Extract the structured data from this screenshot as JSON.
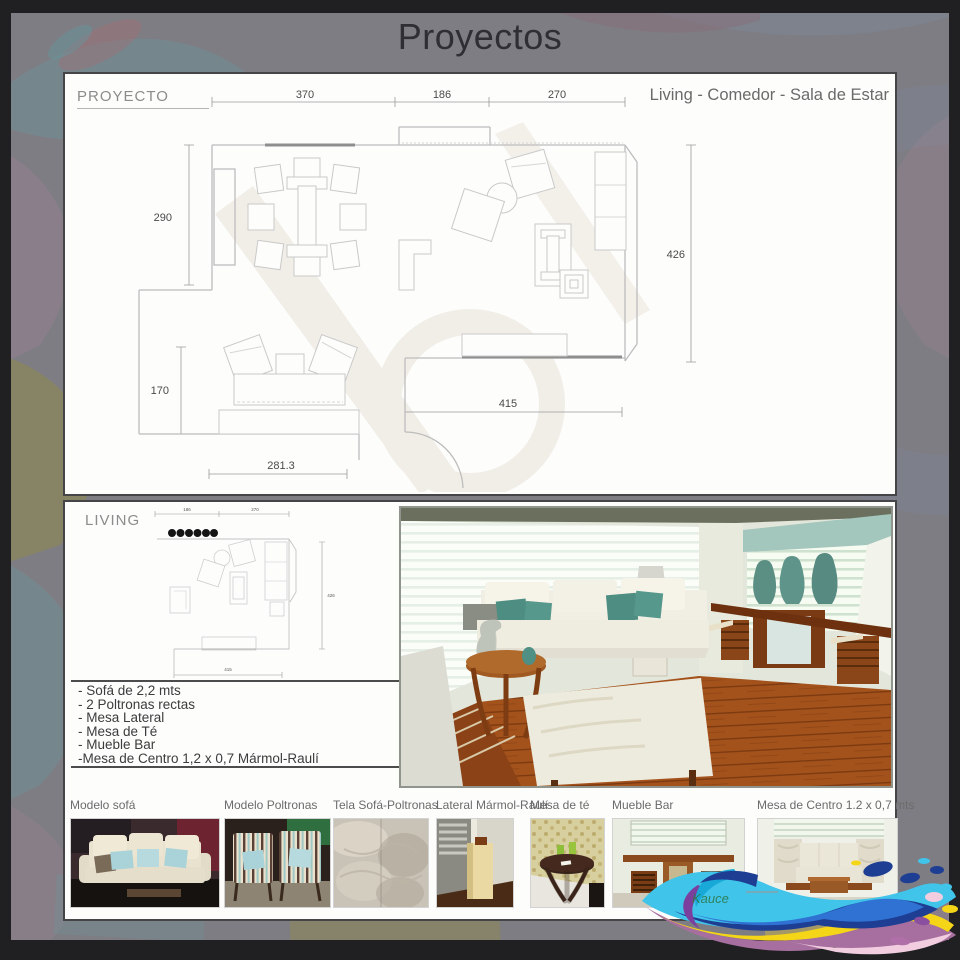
{
  "title": "Proyectos",
  "panel_proyecto": {
    "label": "PROYECTO",
    "subtitle": "Living - Comedor - Sala de Estar",
    "dimensions": {
      "top": [
        "370",
        "186",
        "270"
      ],
      "left_upper": "290",
      "left_lower": "170",
      "right": "426",
      "bottom_right": "415",
      "bottom_left": "281.3"
    }
  },
  "panel_living": {
    "label": "LIVING",
    "plan_dims": {
      "top_left": "186",
      "top_right": "270",
      "right": "426",
      "bottom": "415"
    },
    "furniture_list": [
      "- Sofá de 2,2 mts",
      "- 2 Poltronas rectas",
      "- Mesa Lateral",
      "- Mesa de Té",
      "- Mueble Bar",
      "-Mesa de Centro 1,2 x 0,7 Mármol-Raulí"
    ]
  },
  "thumbnails": [
    {
      "label": "Modelo sofá"
    },
    {
      "label": "Modelo Poltronas"
    },
    {
      "label": "Tela Sofá-Poltronas"
    },
    {
      "label": "Lateral Mármol-Raulí"
    },
    {
      "label": "Mesa de té"
    },
    {
      "label": "Mueble Bar"
    },
    {
      "label": "Mesa de Centro 1.2 x 0,7 mts"
    }
  ],
  "logo": {
    "text": "Kauce"
  },
  "colors": {
    "frame": "#202023",
    "background": "#7e7d83",
    "panel": "#fdfdfc",
    "teal_pillow": "#4e8e82",
    "wood": "#8a4a1e",
    "splash_cyan": "#41c4e9",
    "splash_navy": "#1d3e93",
    "splash_yellow": "#f4d517",
    "splash_purple": "#7b3f9d",
    "splash_mauve": "#a76f9f",
    "splash_pink": "#f2cde0",
    "logo_green": "#2e7a4e"
  }
}
